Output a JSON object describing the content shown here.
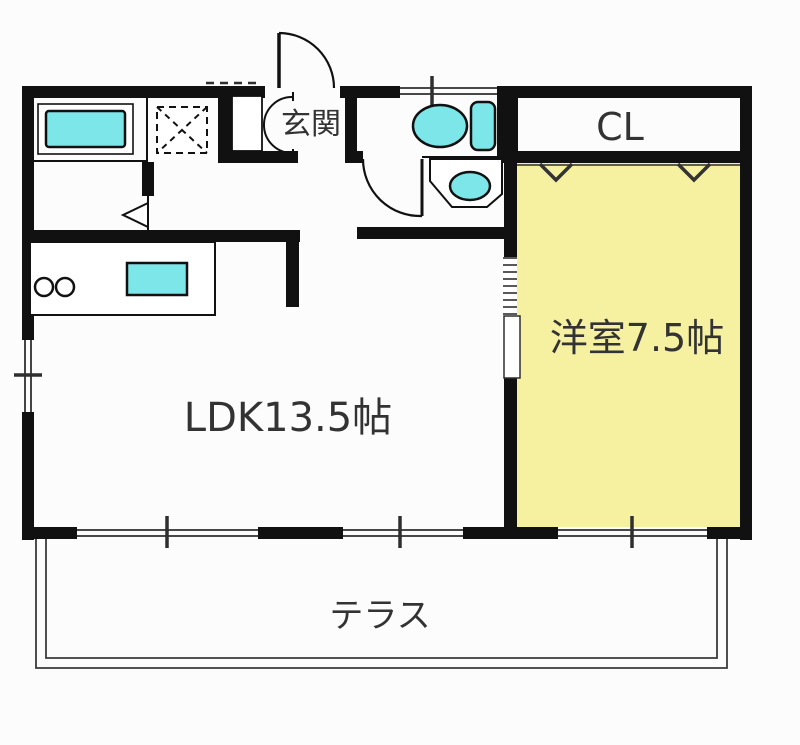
{
  "floorplan": {
    "rooms": {
      "entrance": {
        "label": "玄関"
      },
      "closet": {
        "label": "CL"
      },
      "western_room": {
        "label": "洋室7.5帖"
      },
      "ldk": {
        "label": "LDK13.5帖"
      },
      "terrace": {
        "label": "テラス"
      }
    },
    "colors": {
      "room_fill": "#f5f1a1",
      "fixture_fill": "#7de6e8",
      "wall": "#111111",
      "line": "#2f2f2f",
      "text": "#333333",
      "background": "#fcfcfc"
    }
  }
}
